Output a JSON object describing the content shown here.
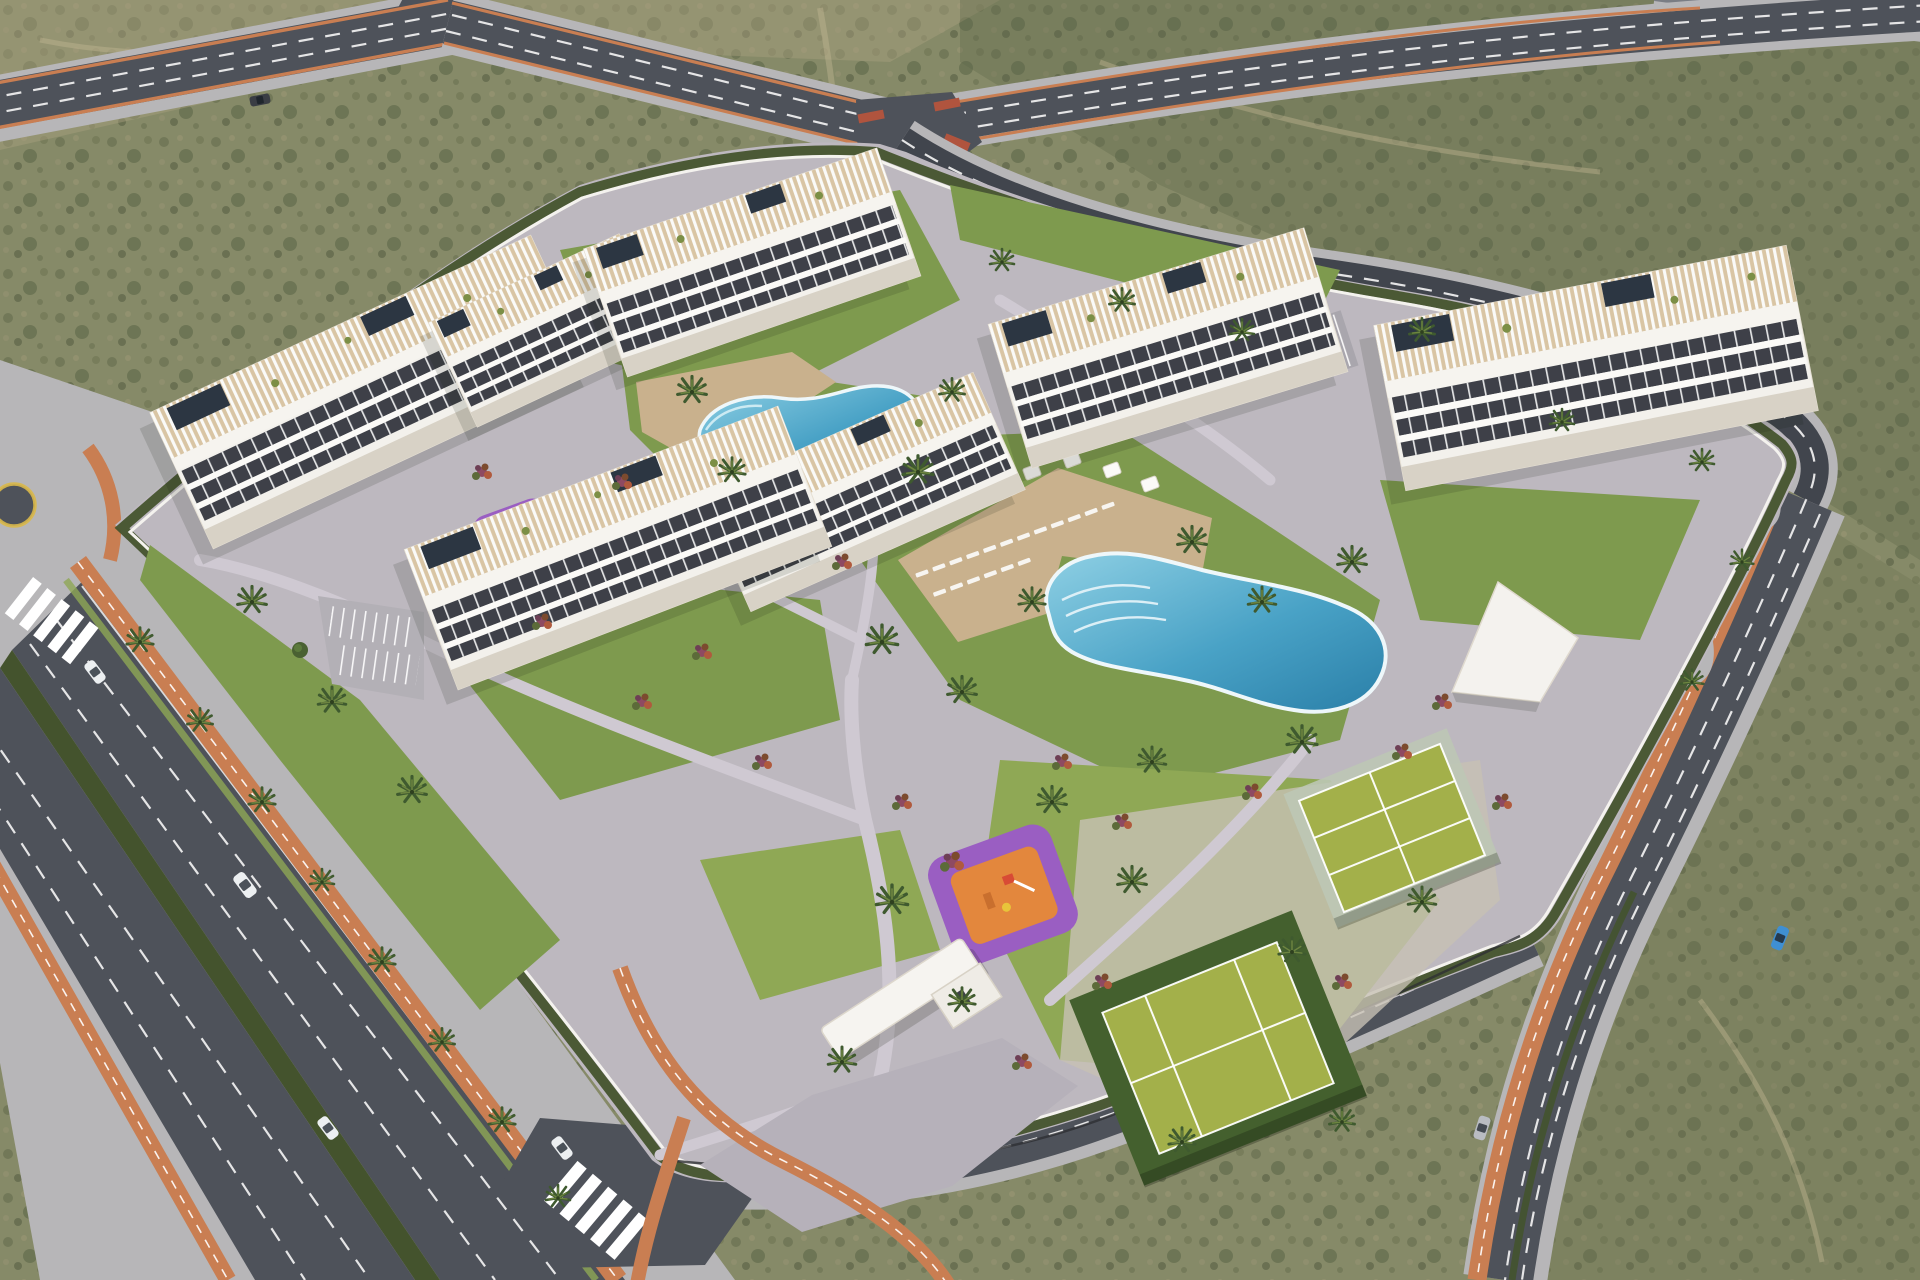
{
  "meta": {
    "description": "Aerial 3D architectural rendering of a white apartment resort community with lagoon pools, sport courts, playgrounds and perimeter avenues surrounded by desert scrubland",
    "render_type": "architectural-visualization",
    "visible_text": ""
  },
  "palette": {
    "desert": "#868A68",
    "desertDark": "#5F664A",
    "desertLight": "#A8A07F",
    "sandTrack": "#C6BA96",
    "asphalt": "#4E525A",
    "asphaltDark": "#41454D",
    "sidewalk": "#B7B6B8",
    "paving": "#BDB8BF",
    "bikeLane": "#C97E52",
    "roadLine": "#F2F2F2",
    "lawn": "#7E9A4E",
    "lawnLight": "#8FA855",
    "hedge": "#44532D",
    "palmGreen": "#3F5A2F",
    "palmLight": "#6D8440",
    "building": "#F3F1EC",
    "buildingShade": "#D8D2C6",
    "terrace": "#D9C5A4",
    "window": "#3E4048",
    "pergola": "#FAFAF8",
    "solar": "#2C3642",
    "poolDeep": "#2E86AE",
    "poolLight": "#8FD0E4",
    "poolRim": "#EEF7FA",
    "deck": "#C9B18D",
    "lounger": "#F7F5F1",
    "courtGreen": "#A3B04A",
    "courtDark": "#44602E",
    "courtLine": "#FFFFFF",
    "playPurple": "#9A5EC2",
    "playOrange": "#E3873D",
    "carWhite": "#ECEFF1",
    "carSilver": "#B9BCC2",
    "carBlue": "#3F8FD2",
    "carDark": "#3A3D44",
    "fence": "#2E2F33",
    "roundaboutRing": "#D9B84A"
  },
  "inventory": {
    "apartment_blocks": 7,
    "swimming_pools": 2,
    "sport_courts": 2,
    "playgrounds": 2,
    "entrance_pavilions": 1,
    "surface_parking_cars": 4,
    "cars_on_roads": 7,
    "bike_lanes": "orange",
    "crosswalks": 2,
    "mini_roundabouts": 1
  }
}
